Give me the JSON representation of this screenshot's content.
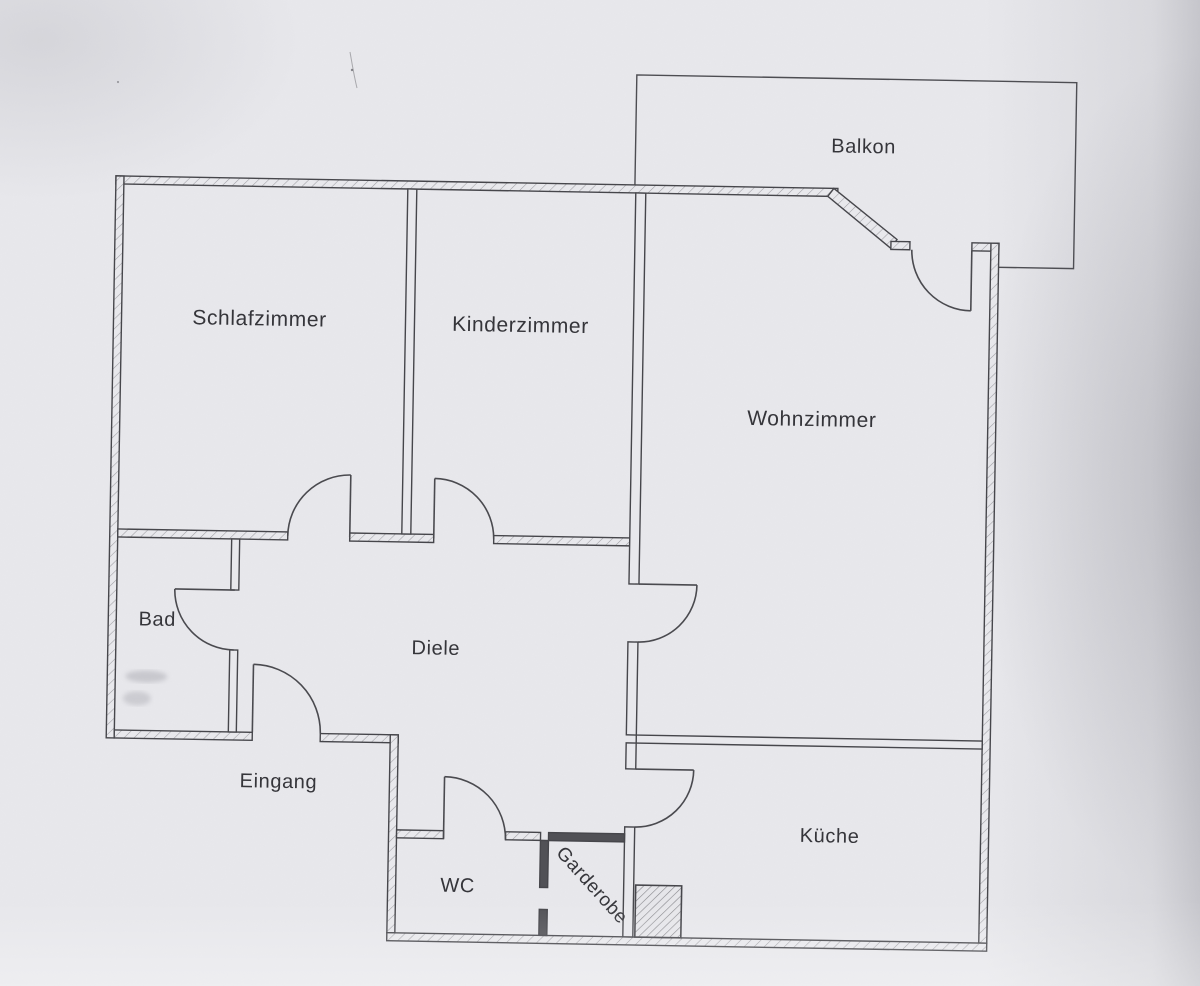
{
  "plan": {
    "type": "apartment-floor-plan",
    "rooms": {
      "balkon": {
        "label": "Balkon"
      },
      "schlafzimmer": {
        "label": "Schlafzimmer"
      },
      "kinderzimmer": {
        "label": "Kinderzimmer"
      },
      "wohnzimmer": {
        "label": "Wohnzimmer"
      },
      "bad": {
        "label": "Bad"
      },
      "diele": {
        "label": "Diele"
      },
      "eingang": {
        "label": "Eingang"
      },
      "wc": {
        "label": "WC"
      },
      "garderobe": {
        "label": "Garderobe"
      },
      "kueche": {
        "label": "Küche"
      }
    },
    "colors": {
      "paper": "#e8e8ec",
      "line": "#46464b",
      "text": "#35353a"
    }
  }
}
